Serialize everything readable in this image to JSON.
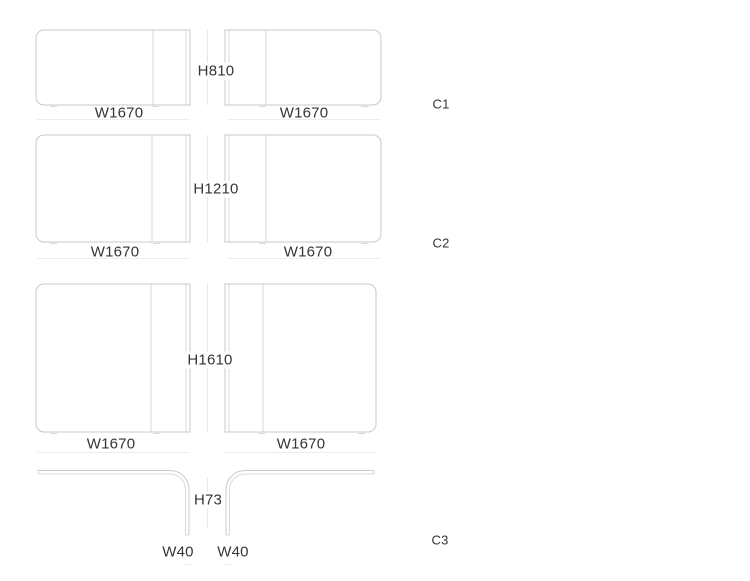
{
  "diagram": {
    "rows": [
      {
        "height_label": "H810",
        "left_width_label": "W1670",
        "right_width_label": "W1670",
        "code": "C1"
      },
      {
        "height_label": "H1210",
        "left_width_label": "W1670",
        "right_width_label": "W1670",
        "code": "C2"
      },
      {
        "height_label": "H1610",
        "left_width_label": "W1670",
        "right_width_label": "W1670"
      },
      {
        "height_label": "H73",
        "left_width_label": "W40",
        "right_width_label": "W40",
        "code": "C3"
      }
    ],
    "colors": {
      "outline_color": "#c8c8c8",
      "inner_line_color": "#d9d9d9",
      "dimension_line_color": "#e7e7e7",
      "reflection_line_color": "#ededed",
      "text_color": "#353535"
    }
  }
}
